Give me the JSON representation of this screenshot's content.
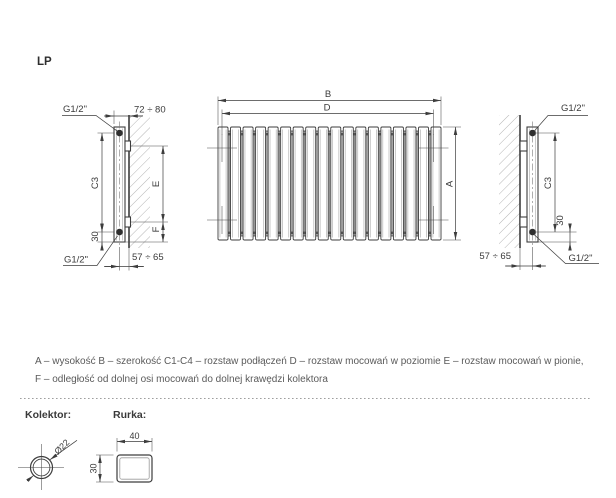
{
  "title": "LP",
  "side_view_left": {
    "thread_top": "G1/2\"",
    "thread_bottom": "G1/2\"",
    "depth_range": "72 ÷ 80",
    "connection_spacing": "C3",
    "mount_vertical": "E",
    "mount_to_collector": "F",
    "collector_offset": "30",
    "wall_to_axis": "57 ÷ 65"
  },
  "front_view": {
    "width": "B",
    "mount_horizontal": "D",
    "height": "A"
  },
  "side_view_right": {
    "thread_top": "G1/2\"",
    "thread_bottom": "G1/2\"",
    "connection_spacing": "C3",
    "collector_offset": "30",
    "wall_to_axis": "57 ÷ 65"
  },
  "legend": {
    "line1": "A – wysokość B – szerokość C1-C4 – rozstaw podłączeń D – rozstaw mocowań w poziomie E – rozstaw mocowań w pionie,",
    "line2": "F – odległość od dolnej osi mocowań do dolnej krawędzi kolektora"
  },
  "details": {
    "kolektor_label": "Kolektor:",
    "rurka_label": "Rurka:",
    "kolektor_diameter": "Ø22",
    "rurka_width": "40",
    "rurka_height": "30"
  },
  "colors": {
    "line": "#3d3d3d",
    "hatch": "#b5b5b5",
    "legend_text": "#5a5a5a"
  }
}
